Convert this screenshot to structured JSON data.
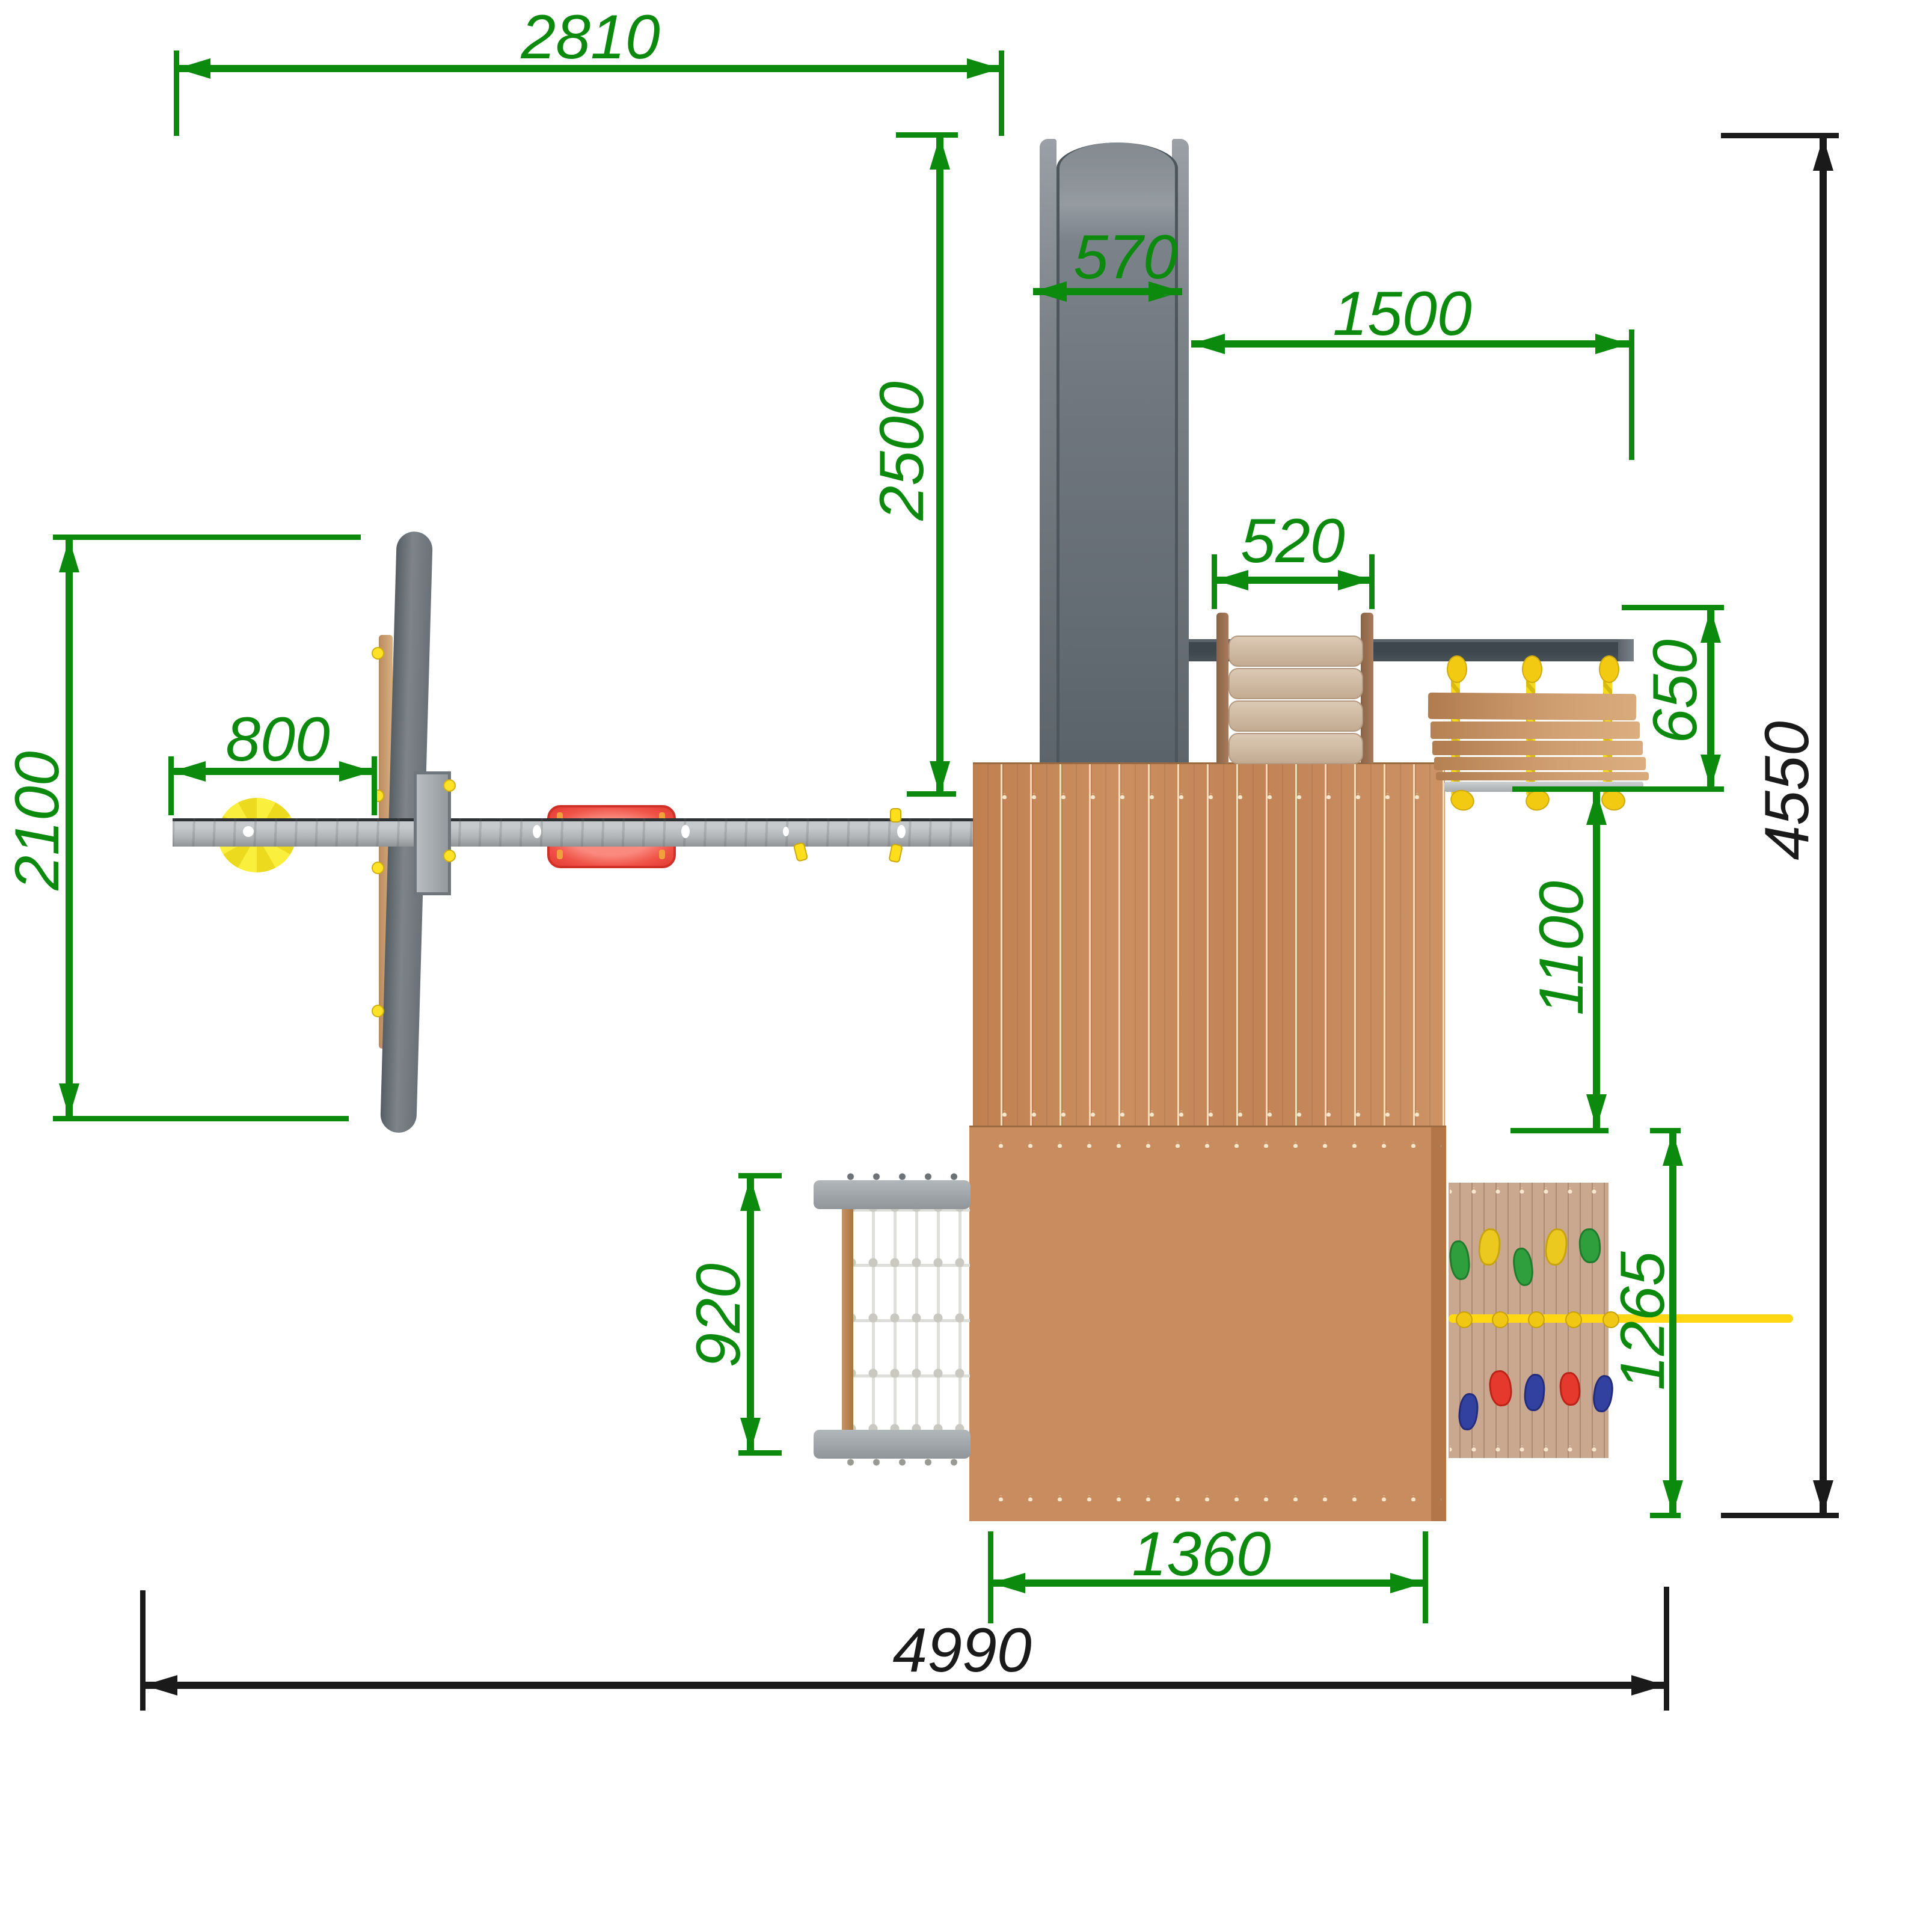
{
  "dims": {
    "d2810": {
      "label": "2810"
    },
    "d2500": {
      "label": "2500"
    },
    "d570": {
      "label": "570"
    },
    "d1500": {
      "label": "1500"
    },
    "d520": {
      "label": "520"
    },
    "d650": {
      "label": "650"
    },
    "d2100": {
      "label": "2100"
    },
    "d800": {
      "label": "800"
    },
    "d1100": {
      "label": "1100"
    },
    "d920": {
      "label": "920"
    },
    "d1265": {
      "label": "1265"
    },
    "d1360": {
      "label": "1360"
    },
    "d4550": {
      "label": "4550"
    },
    "d4990": {
      "label": "4990"
    }
  },
  "colors": {
    "dimension_green": "#0b8a0e",
    "overall_black": "#1a1a1a",
    "deck_wood": "#c58655",
    "slide_gray": "#6e757d",
    "swing_beam_gray": "#b3b7b9",
    "monkey_bar_gray": "#434b52",
    "rope_yellow": "#f2cf14",
    "seat_red": "#ee4338",
    "disc_yellow": "#f6e82f",
    "hold_green": "#2f9e3d",
    "hold_yellow": "#ecc91f",
    "hold_red": "#e6392e",
    "hold_blue": "#3240a0"
  }
}
